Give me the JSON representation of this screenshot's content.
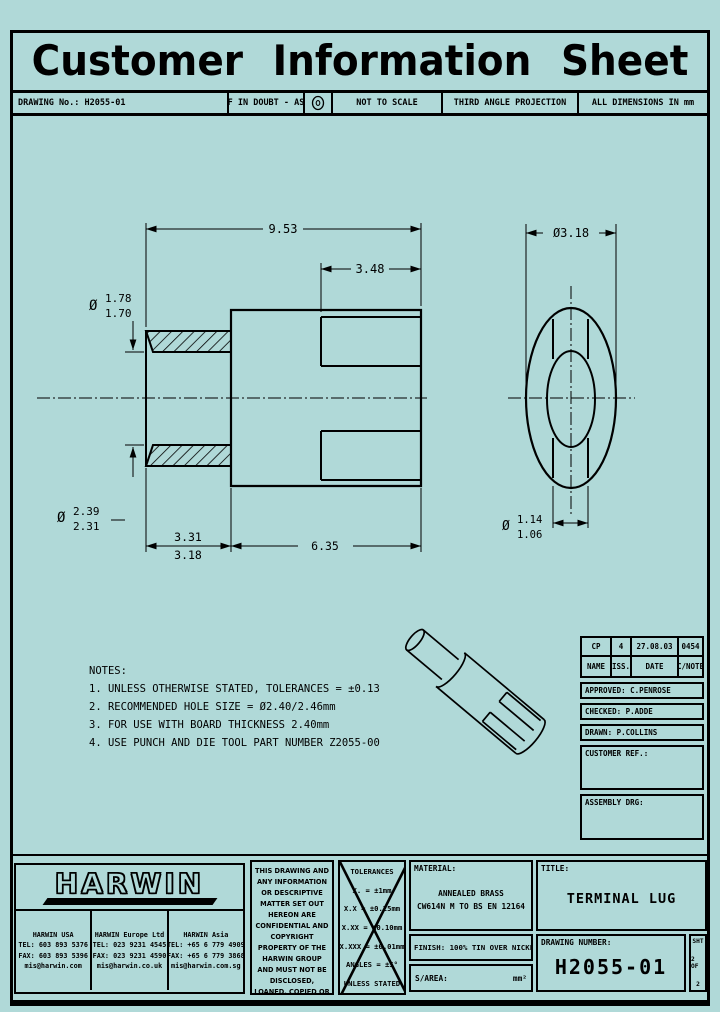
{
  "page": {
    "title": "Customer Information Sheet",
    "bg_color": "#b0d9d8",
    "line_color": "#000000"
  },
  "header": {
    "drawing_no": "DRAWING No.: H2055-01",
    "if_in_doubt": "IF IN DOUBT - ASK",
    "projection_symbol": "third-angle-projection-symbol",
    "not_to_scale": "NOT TO SCALE",
    "third_angle": "THIRD ANGLE PROJECTION",
    "all_dims": "ALL DIMENSIONS IN mm"
  },
  "drawing": {
    "dims": {
      "dia_symbol": "Ø",
      "overall_length": "9.53",
      "slot_length": "3.48",
      "bore_dia_max": "1.78",
      "bore_dia_min": "1.70",
      "barrel_dia_max": "2.39",
      "barrel_dia_min": "2.31",
      "barrel_len_max": "3.31",
      "barrel_len_min": "3.18",
      "body_length": "6.35",
      "outer_dia": "Ø3.18",
      "slot_width_max": "1.14",
      "slot_width_min": "1.06"
    }
  },
  "notes": {
    "title": "NOTES:",
    "items": [
      "1. UNLESS OTHERWISE STATED, TOLERANCES = ±0.13",
      "2. RECOMMENDED HOLE SIZE = Ø2.40/2.46mm",
      "3. FOR USE WITH BOARD THICKNESS 2.40mm",
      "4. USE PUNCH AND DIE TOOL PART NUMBER Z2055-00"
    ]
  },
  "rev_table": {
    "rev_name": "CP",
    "rev_iss": "4",
    "rev_date": "27.08.03",
    "rev_cnote": "0454",
    "name_label": "NAME",
    "iss_label": "ISS.",
    "date_label": "DATE",
    "cnote_label": "C/NOTE",
    "approved": "APPROVED: C.PENROSE",
    "checked": "CHECKED:  P.ADDE",
    "drawn": "DRAWN:  P.COLLINS",
    "customer_ref": "CUSTOMER REF.:",
    "assembly_drg": "ASSEMBLY DRG:"
  },
  "company": {
    "logo": "HARWIN",
    "offices": [
      {
        "name": "HARWIN USA",
        "tel": "TEL: 603 893 5376",
        "fax": "FAX: 603 893 5396",
        "email": "mis@harwin.com"
      },
      {
        "name": "HARWIN Europe Ltd",
        "tel": "TEL: 023 9231 4545",
        "fax": "FAX: 023 9231 4590",
        "email": "mis@harwin.co.uk"
      },
      {
        "name": "HARWIN Asia",
        "tel": "TEL: +65 6 779 4909",
        "fax": "FAX: +65 6 779 3868",
        "email": "mis@harwin.com.sg"
      }
    ]
  },
  "disclaimer": "THIS DRAWING AND ANY INFORMATION OR DESCRIPTIVE MATTER SET OUT HEREON ARE CONFIDENTIAL AND COPYRIGHT PROPERTY OF THE HARWIN GROUP AND MUST NOT BE DISCLOSED, LOANED, COPIED OR USED FOR MANUFACTURING, TENDERING OR FOR ANY OTHER PURPOSE WITHOUT THEIR WRITTEN PERMISSION.",
  "tolerances": {
    "title": "TOLERANCES",
    "lines": [
      "X.    = ±1mm",
      "X.X   = ±0.25mm",
      "X.XX  = ±0.10mm",
      "X.XXX = ±0.01mm",
      "ANGLES = ±5°",
      "UNLESS STATED"
    ]
  },
  "title_block": {
    "material_label": "MATERIAL:",
    "material_line1": "ANNEALED BRASS",
    "material_line2": "CW614N M TO BS EN 12164",
    "title_label": "TITLE:",
    "title_value": "TERMINAL LUG",
    "finish": "FINISH: 100% TIN OVER NICKEL",
    "sarea_label": "S/AREA:",
    "sarea_unit": "mm²",
    "drawing_number_label": "DRAWING NUMBER:",
    "drawing_number": "H2055-01",
    "sheet_line1": "SHT",
    "sheet_line2": "2 OF",
    "sheet_line3": "2"
  }
}
